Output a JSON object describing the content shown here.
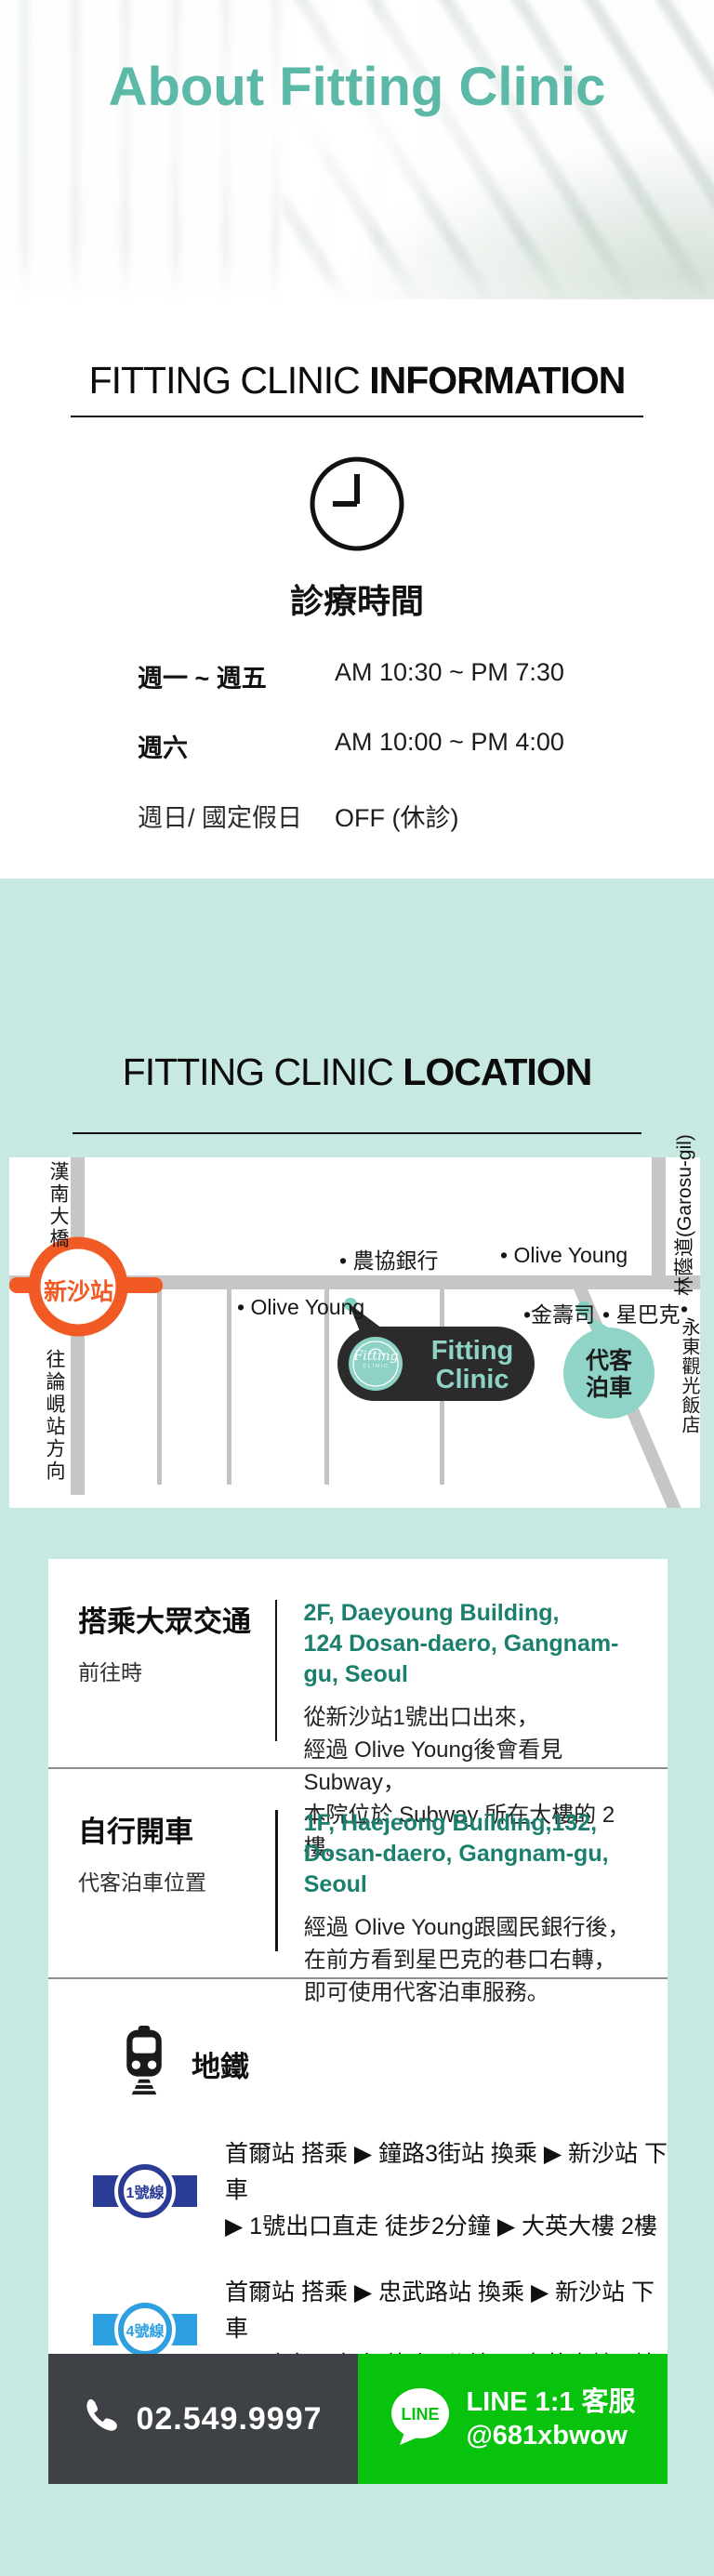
{
  "hero": {
    "title": "About Fitting Clinic"
  },
  "info": {
    "heading_light": "FITTING CLINIC",
    "heading_bold": "INFORMATION",
    "clock_icon": "clock-icon",
    "hours_title": "診療時間",
    "hours": [
      {
        "label": "週一 ~ 週五",
        "value": "AM 10:30 ~ PM 7:30"
      },
      {
        "label": "週六",
        "value": "AM 10:00 ~ PM 4:00"
      },
      {
        "label": "週日/ 國定假日",
        "value": "OFF (休診)"
      }
    ]
  },
  "location": {
    "heading_light": "FITTING CLINIC",
    "heading_bold": "LOCATION",
    "map": {
      "station": "新沙站",
      "bridge": "漢南大橋",
      "direction": "往論峴站方向",
      "garosu": "林蔭道(Garosu-gil)",
      "bank": "• 農協銀行",
      "olive_top": "• Olive Young",
      "olive_bottom": "• Olive Young",
      "sushi": "•金壽司",
      "starbucks": "• 星巴克",
      "hotel_bullet": "•",
      "hotel": "永東觀光飯店",
      "clinic_line1": "Fitting",
      "clinic_line2": "Clinic",
      "logo_script": "Fitting",
      "logo_sub": "CLINIC",
      "valet_line1": "代客",
      "valet_line2": "泊車",
      "road_color": "#c6c6c6",
      "station_color": "#f15a24",
      "bubble_color": "#2b2b2b",
      "teal_color": "#8fd4c6"
    },
    "cards": [
      {
        "title": "搭乘大眾交通",
        "subtitle": "前往時",
        "address1": "2F, Daeyoung Building,",
        "address2": "124 Dosan-daero, Gangnam-gu, Seoul",
        "body1": "從新沙站1號出口出來，",
        "body2": "經過 Olive Young後會看見Subway，",
        "body3": "本院位於 Subway 所在大樓的 2 樓。"
      },
      {
        "title": "自行開車",
        "subtitle": "代客泊車位置",
        "address1": "1F, Haejeong Building,132,",
        "address2": "Dosan-daero, Gangnam-gu, Seoul",
        "body1": "經過 Olive Young跟國民銀行後，",
        "body2": "在前方看到星巴克的巷口右轉，",
        "body3": "即可使用代客泊車服務。"
      }
    ],
    "subway": {
      "title": "地鐵",
      "routes": [
        {
          "badge": "1號線",
          "color": "#2a3c96",
          "line1": "首爾站 搭乘 ▶ 鐘路3街站 換乘 ▶ 新沙站 下車",
          "line2": "▶ 1號出口直走 徒步2分鐘 ▶ 大英大樓 2樓"
        },
        {
          "badge": "4號線",
          "color": "#2e9fe0",
          "line1": "首爾站 搭乘 ▶ 忠武路站 換乘 ▶ 新沙站 下車",
          "line2": "▶ 1號出口直走 徒步2分鐘 ▶ 大英大樓 2樓"
        }
      ]
    }
  },
  "footer": {
    "phone": "02.549.9997",
    "line_logo": "LINE",
    "line_title": "LINE 1:1 客服",
    "line_id": "@681xbwow",
    "phone_bg": "#3e4145",
    "line_bg": "#08c30d"
  },
  "colors": {
    "title_teal": "#5cb9a8",
    "mint_bg": "#c8e9e2",
    "address_green": "#1b7f6d"
  }
}
